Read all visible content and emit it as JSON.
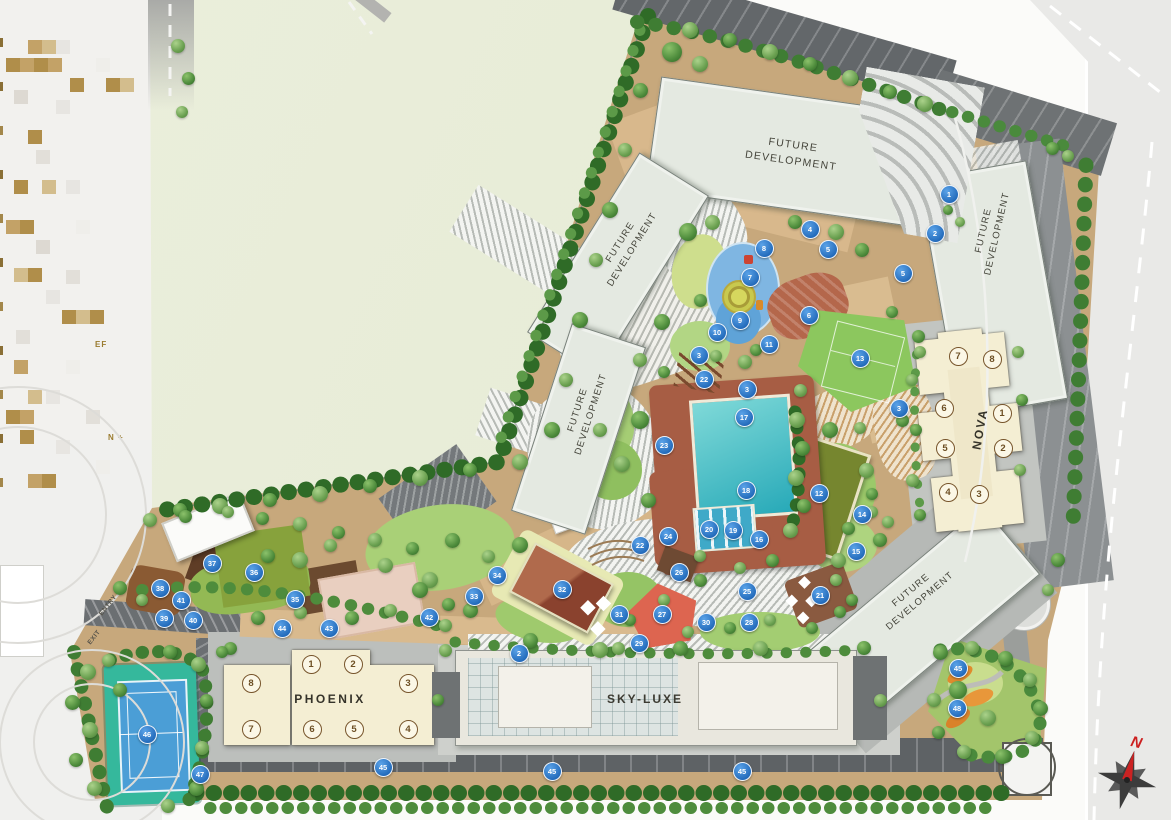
{
  "plan": {
    "legend_fragments": [
      "EF",
      "N +"
    ],
    "roads": {
      "entry_label": "ENTRY",
      "exit_label": "EXIT"
    },
    "compass": {
      "north_label": "N"
    },
    "buildings": {
      "future_top": {
        "label": "FUTURE DEVELOPMENT"
      },
      "future_left_upper": {
        "label": "FUTURE DEVELOPMENT"
      },
      "future_left_lower": {
        "label": "FUTURE DEVELOPMENT"
      },
      "future_right": {
        "label": "FUTURE DEVELOPMENT"
      },
      "future_bottom_right": {
        "label": "FUTURE DEVELOPMENT"
      },
      "skyluxe": {
        "label": "SKY-LUXE"
      },
      "phoenix": {
        "label": "PHOENIX",
        "units": [
          {
            "n": "1",
            "x": 310,
            "y": 663
          },
          {
            "n": "2",
            "x": 352,
            "y": 663
          },
          {
            "n": "3",
            "x": 407,
            "y": 682
          },
          {
            "n": "4",
            "x": 407,
            "y": 728
          },
          {
            "n": "5",
            "x": 353,
            "y": 728
          },
          {
            "n": "6",
            "x": 311,
            "y": 728
          },
          {
            "n": "7",
            "x": 250,
            "y": 728
          },
          {
            "n": "8",
            "x": 250,
            "y": 682
          }
        ]
      },
      "nova": {
        "label": "NOVA",
        "units": [
          {
            "n": "1",
            "x": 1001,
            "y": 412
          },
          {
            "n": "2",
            "x": 1002,
            "y": 447
          },
          {
            "n": "3",
            "x": 978,
            "y": 493
          },
          {
            "n": "4",
            "x": 947,
            "y": 491
          },
          {
            "n": "5",
            "x": 944,
            "y": 447
          },
          {
            "n": "6",
            "x": 943,
            "y": 407
          },
          {
            "n": "7",
            "x": 957,
            "y": 355
          },
          {
            "n": "8",
            "x": 991,
            "y": 358
          }
        ]
      }
    },
    "markers": [
      {
        "n": "1",
        "x": 948,
        "y": 193
      },
      {
        "n": "2",
        "x": 934,
        "y": 232
      },
      {
        "n": "2",
        "x": 518,
        "y": 652
      },
      {
        "n": "3",
        "x": 698,
        "y": 354
      },
      {
        "n": "3",
        "x": 746,
        "y": 388
      },
      {
        "n": "3",
        "x": 898,
        "y": 407
      },
      {
        "n": "4",
        "x": 809,
        "y": 228
      },
      {
        "n": "5",
        "x": 827,
        "y": 248
      },
      {
        "n": "5",
        "x": 902,
        "y": 272
      },
      {
        "n": "6",
        "x": 808,
        "y": 314
      },
      {
        "n": "7",
        "x": 749,
        "y": 276
      },
      {
        "n": "8",
        "x": 763,
        "y": 247
      },
      {
        "n": "9",
        "x": 739,
        "y": 319
      },
      {
        "n": "10",
        "x": 716,
        "y": 331
      },
      {
        "n": "11",
        "x": 768,
        "y": 343
      },
      {
        "n": "12",
        "x": 818,
        "y": 492
      },
      {
        "n": "13",
        "x": 859,
        "y": 357
      },
      {
        "n": "14",
        "x": 861,
        "y": 513
      },
      {
        "n": "15",
        "x": 855,
        "y": 550
      },
      {
        "n": "16",
        "x": 758,
        "y": 538
      },
      {
        "n": "17",
        "x": 743,
        "y": 416
      },
      {
        "n": "18",
        "x": 745,
        "y": 489
      },
      {
        "n": "19",
        "x": 732,
        "y": 529
      },
      {
        "n": "20",
        "x": 708,
        "y": 528
      },
      {
        "n": "21",
        "x": 819,
        "y": 594
      },
      {
        "n": "22",
        "x": 703,
        "y": 378
      },
      {
        "n": "22",
        "x": 639,
        "y": 544
      },
      {
        "n": "23",
        "x": 663,
        "y": 444
      },
      {
        "n": "24",
        "x": 667,
        "y": 535
      },
      {
        "n": "25",
        "x": 746,
        "y": 590
      },
      {
        "n": "26",
        "x": 678,
        "y": 571
      },
      {
        "n": "27",
        "x": 661,
        "y": 613
      },
      {
        "n": "28",
        "x": 748,
        "y": 621
      },
      {
        "n": "29",
        "x": 638,
        "y": 642
      },
      {
        "n": "30",
        "x": 705,
        "y": 621
      },
      {
        "n": "31",
        "x": 618,
        "y": 613
      },
      {
        "n": "32",
        "x": 561,
        "y": 588
      },
      {
        "n": "33",
        "x": 473,
        "y": 595
      },
      {
        "n": "34",
        "x": 496,
        "y": 574
      },
      {
        "n": "35",
        "x": 294,
        "y": 598
      },
      {
        "n": "36",
        "x": 253,
        "y": 571
      },
      {
        "n": "37",
        "x": 211,
        "y": 562
      },
      {
        "n": "38",
        "x": 159,
        "y": 587
      },
      {
        "n": "39",
        "x": 163,
        "y": 617
      },
      {
        "n": "40",
        "x": 192,
        "y": 619
      },
      {
        "n": "41",
        "x": 180,
        "y": 599
      },
      {
        "n": "42",
        "x": 428,
        "y": 616
      },
      {
        "n": "43",
        "x": 328,
        "y": 627
      },
      {
        "n": "44",
        "x": 281,
        "y": 627
      },
      {
        "n": "45",
        "x": 957,
        "y": 667
      },
      {
        "n": "45",
        "x": 382,
        "y": 766
      },
      {
        "n": "45",
        "x": 551,
        "y": 770
      },
      {
        "n": "45",
        "x": 741,
        "y": 770
      },
      {
        "n": "46",
        "x": 146,
        "y": 733
      },
      {
        "n": "47",
        "x": 199,
        "y": 773
      },
      {
        "n": "48",
        "x": 956,
        "y": 707
      }
    ],
    "colors": {
      "marker_blue": "#2a72c8",
      "building_cream": "#f4eed3",
      "future_building": "#e4e9e1",
      "pool_teal": "#2fb0bf",
      "tennis_blue": "#4b9ed6",
      "lawn_green": "#8cc75e",
      "ground_tan": "#cba97e",
      "road_dark": "#63676a",
      "north_red": "#cc2222"
    }
  }
}
